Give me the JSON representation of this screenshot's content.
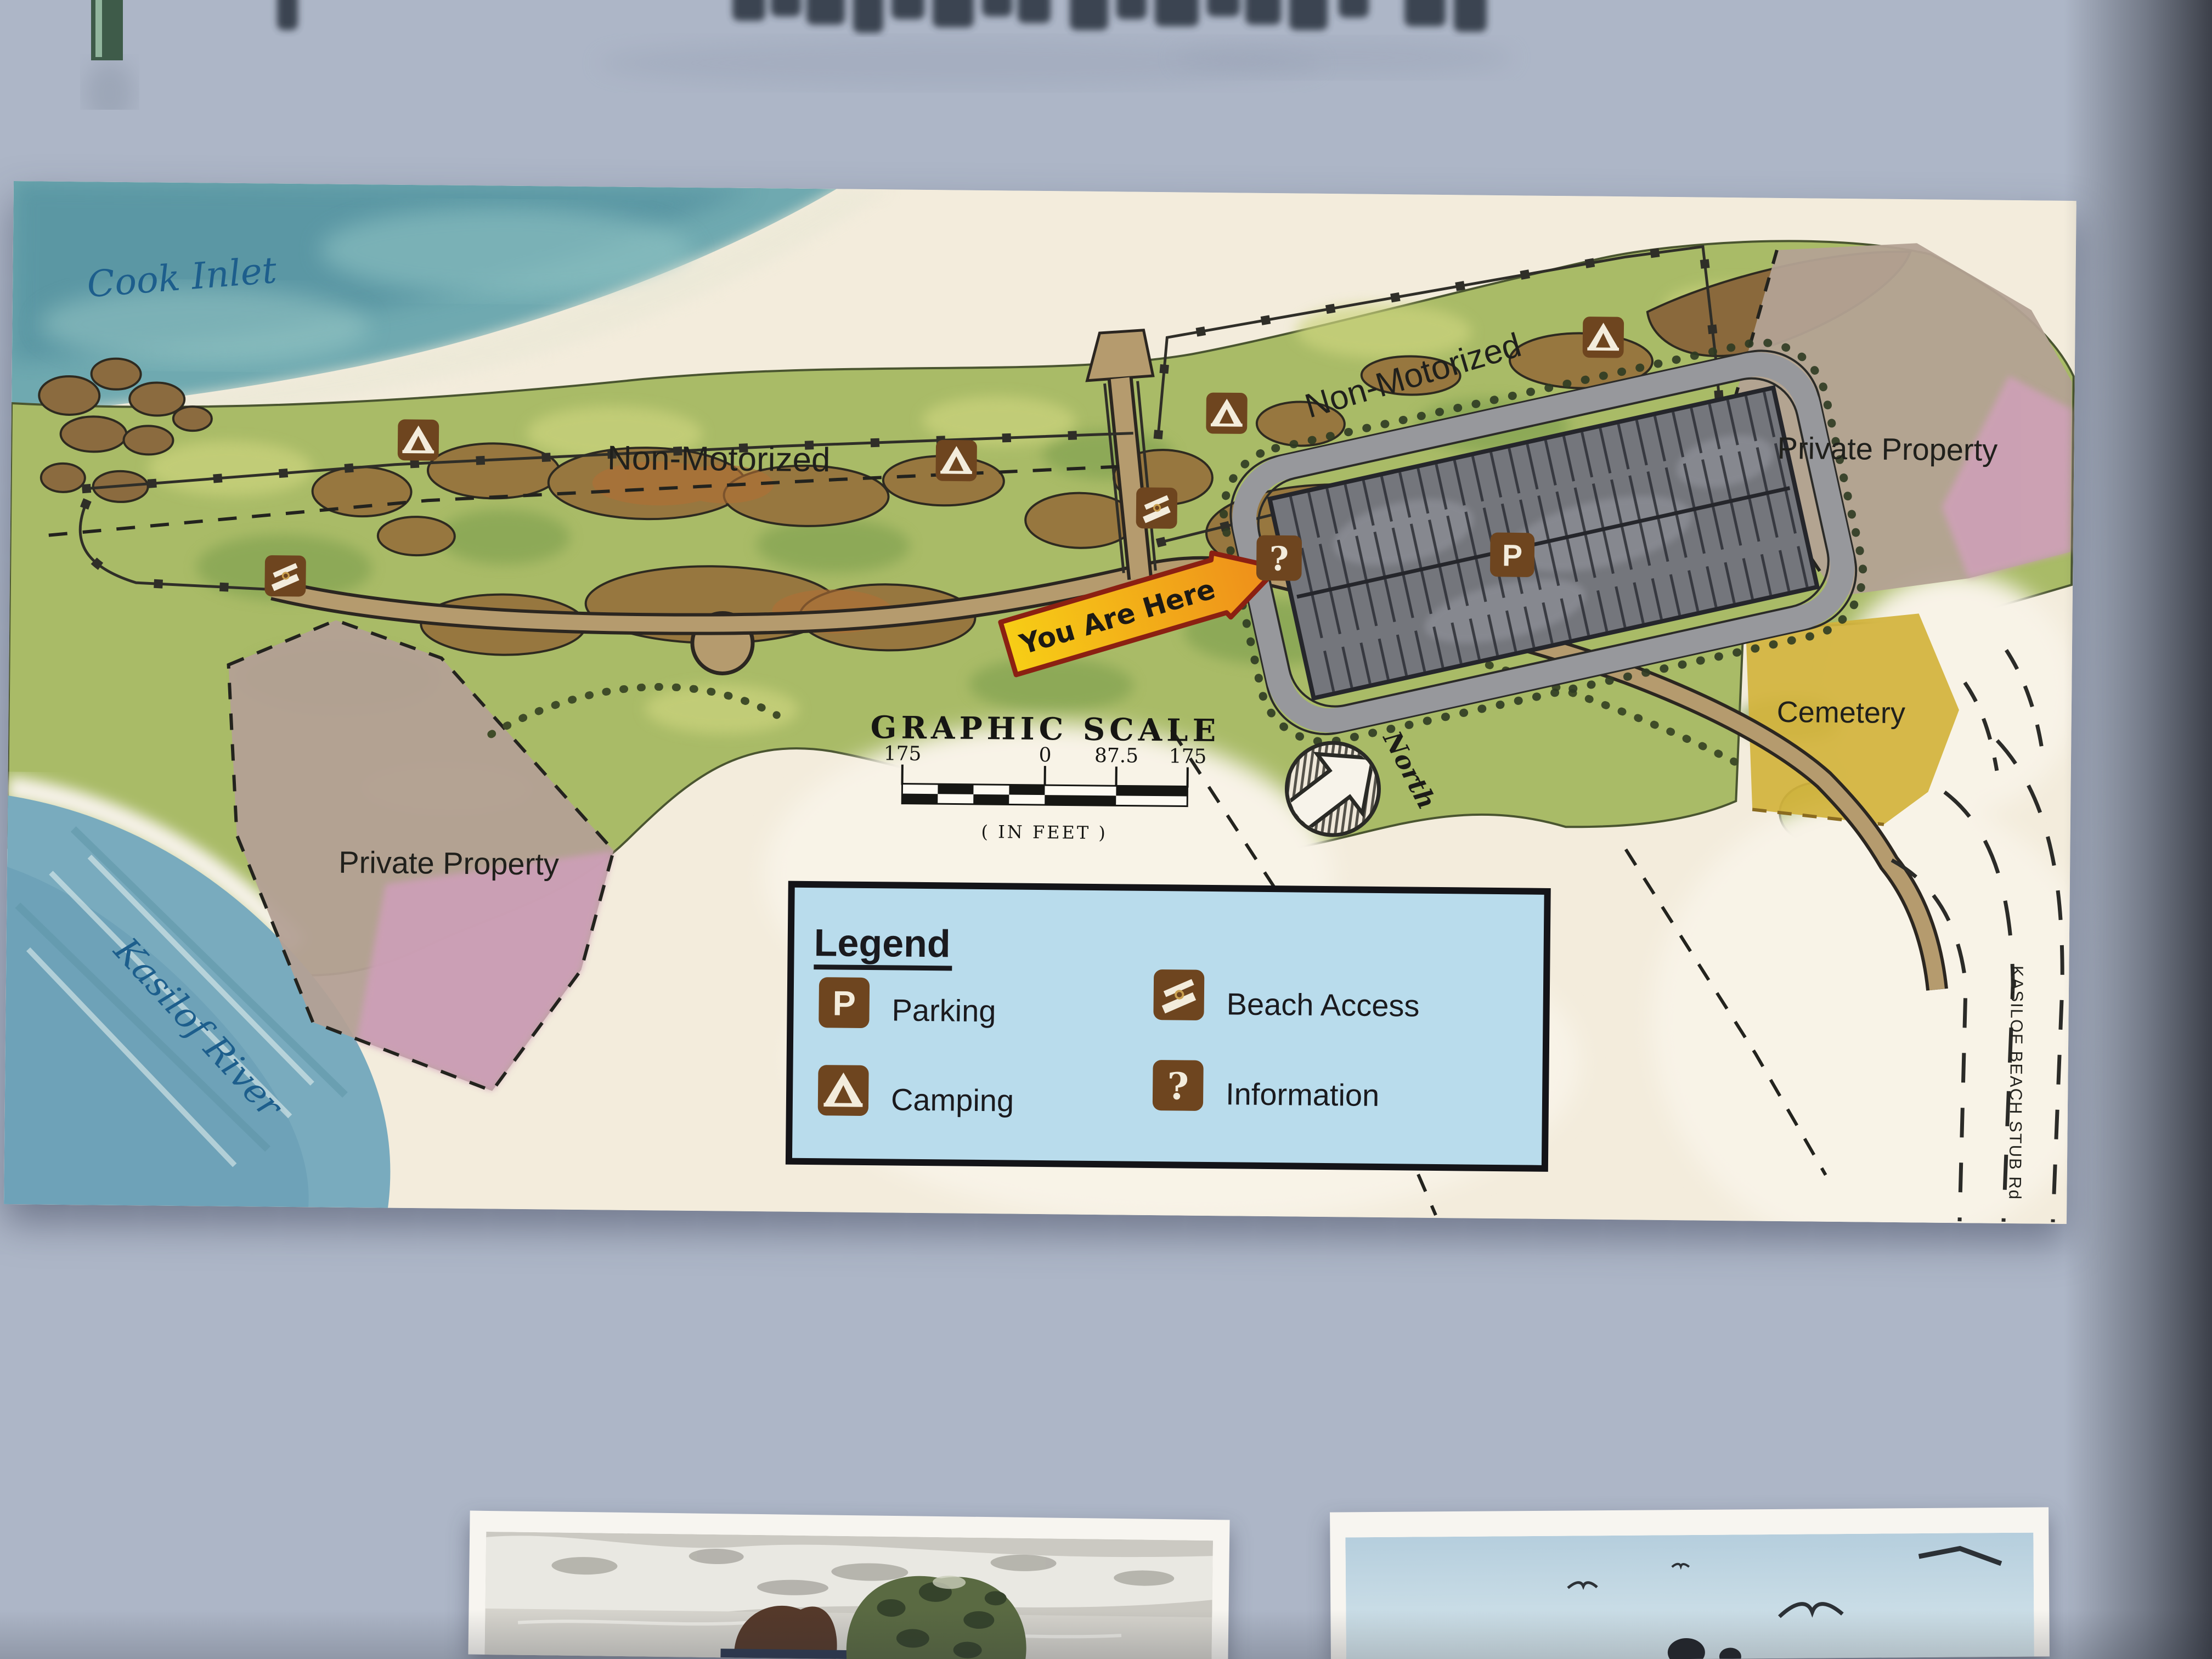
{
  "map": {
    "labels": {
      "cook_inlet": "Cook Inlet",
      "kasilof_river": "Kasilof River",
      "non_motorized": "Non-Motorized",
      "private_property": "Private Property",
      "cemetery": "Cemetery",
      "road_kasilof_beach_stub": "KASILOF BEACH STUB Rd",
      "you_are_here": "You Are Here",
      "north": "North"
    },
    "scale": {
      "title": "GRAPHIC SCALE",
      "ticks": [
        "175",
        "0",
        "87.5",
        "175"
      ],
      "units_note": "( IN FEET )"
    },
    "legend": {
      "title": "Legend",
      "items": [
        {
          "icon": "parking-icon",
          "label": "Parking"
        },
        {
          "icon": "camping-icon",
          "label": "Camping"
        },
        {
          "icon": "beach-access-icon",
          "label": "Beach Access"
        },
        {
          "icon": "information-icon",
          "label": "Information"
        }
      ]
    },
    "icon_glyphs": {
      "parking": "P",
      "information": "?"
    },
    "colors": {
      "legend_bg": "#b9dcec",
      "icon_brown": "#6e451f",
      "water_teal": "#6fa9b0",
      "river_blue": "#79abbe",
      "cemetery_yellow": "#d2b33c",
      "parcel_pink": "#cf9fba",
      "road_tan": "#b59b6e",
      "parking_gray": "#74767c",
      "you_are_here_gradient": [
        "#f7ce16",
        "#ee8c1b"
      ],
      "map_label_blue": "#1d5e8c"
    }
  }
}
